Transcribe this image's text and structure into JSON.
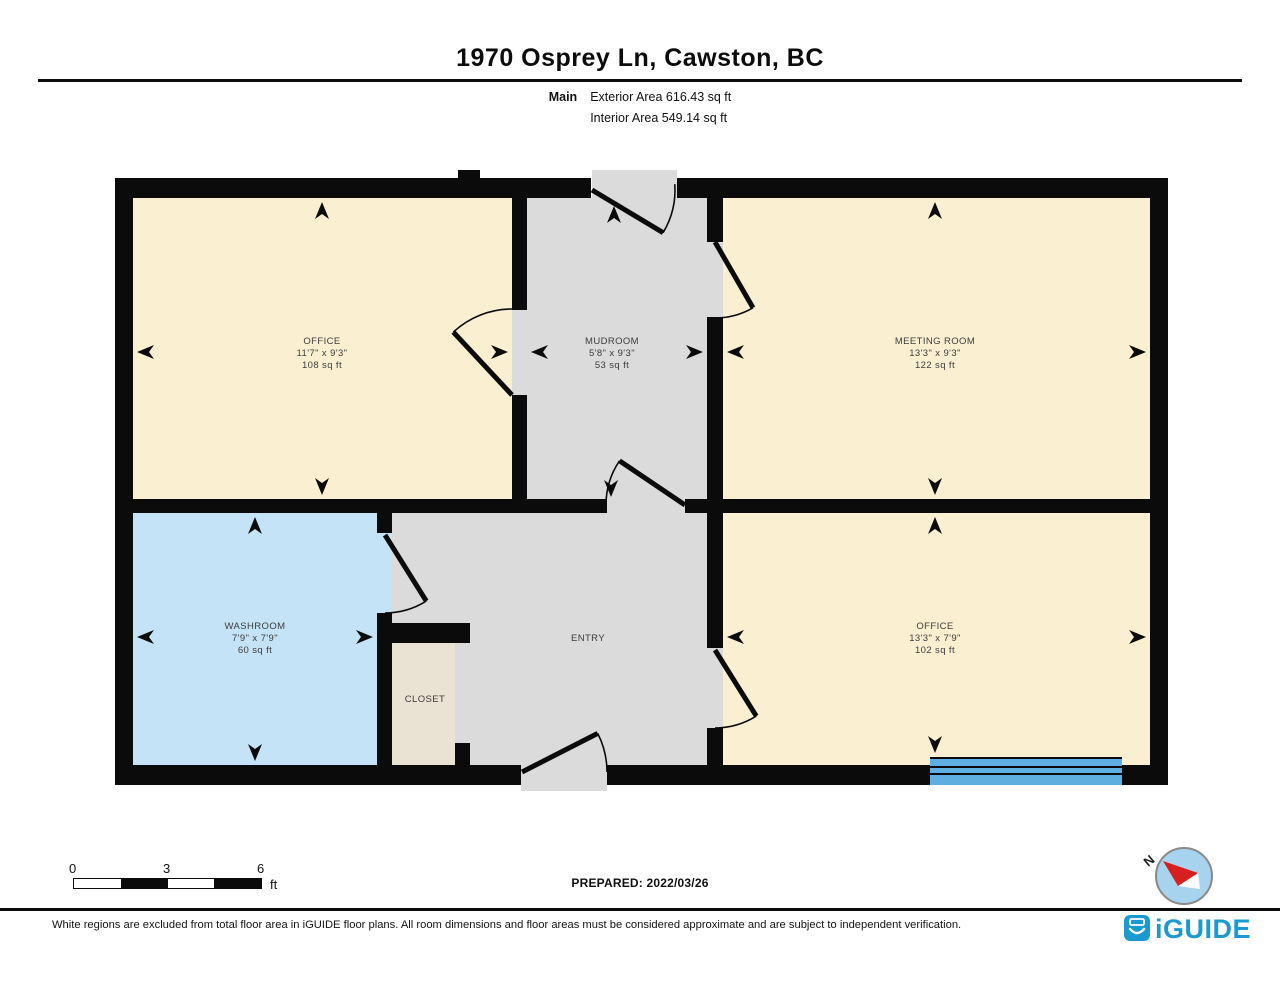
{
  "page": {
    "title": "1970 Osprey Ln, Cawston, BC",
    "floor_label": "Main",
    "exterior_area": "Exterior Area 616.43 sq ft",
    "interior_area": "Interior Area 549.14 sq ft",
    "prepared": "PREPARED: 2022/03/26",
    "disclaimer": "White regions are excluded from total floor area in iGUIDE floor plans. All room dimensions and floor areas must be considered approximate and are subject to independent verification.",
    "brand": "iGUIDE",
    "compass_label": "N"
  },
  "scale_bar": {
    "labels": [
      "0",
      "3",
      "6"
    ],
    "unit": "ft"
  },
  "colors": {
    "wall": "#0b0b0b",
    "room_cream": "#FAEFD1",
    "room_gray": "#DBDBDB",
    "room_blue": "#C5E3F7",
    "room_tan": "#EAE2D2",
    "window_blue": "#5FAEE0",
    "brand_blue": "#1B9AD2",
    "compass_fill": "#A8D3EE",
    "needle_red": "#D81F1F",
    "label_text": "#3c3c3c"
  },
  "floorplan": {
    "rooms": [
      {
        "name": "OFFICE",
        "dims": "11'7\" x 9'3\"",
        "area": "108 sq ft",
        "fill": "room_cream",
        "rect": [
          133,
          198,
          379,
          301
        ],
        "label": [
          322,
          352
        ],
        "arrows": [
          [
            "up",
            322,
            202
          ],
          [
            "down",
            322,
            495
          ],
          [
            "left",
            137,
            352
          ],
          [
            "right",
            508,
            352
          ]
        ]
      },
      {
        "name": "MUDROOM",
        "dims": "5'8\" x 9'3\"",
        "area": "53 sq ft",
        "fill": "room_gray",
        "rect": [
          527,
          198,
          180,
          301
        ],
        "label": [
          612,
          352
        ],
        "arrows": [
          [
            "up",
            614,
            206
          ],
          [
            "down",
            611,
            497
          ],
          [
            "left",
            531,
            352
          ],
          [
            "right",
            703,
            352
          ]
        ]
      },
      {
        "name": "MEETING ROOM",
        "dims": "13'3\" x 9'3\"",
        "area": "122 sq ft",
        "fill": "room_cream",
        "rect": [
          723,
          198,
          427,
          301
        ],
        "label": [
          935,
          352
        ],
        "arrows": [
          [
            "up",
            935,
            202
          ],
          [
            "down",
            935,
            495
          ],
          [
            "left",
            727,
            352
          ],
          [
            "right",
            1146,
            352
          ]
        ]
      },
      {
        "name": "WASHROOM",
        "dims": "7'9\" x 7'9\"",
        "area": "60 sq ft",
        "fill": "room_blue",
        "rect": [
          133,
          513,
          244,
          252
        ],
        "label": [
          255,
          637
        ],
        "arrows": [
          [
            "up",
            255,
            517
          ],
          [
            "down",
            255,
            761
          ],
          [
            "left",
            137,
            637
          ],
          [
            "right",
            373,
            637
          ]
        ]
      },
      {
        "name": "ENTRY",
        "dims": "",
        "area": "",
        "fill": "room_gray",
        "rect": [
          392,
          513,
          315,
          252
        ],
        "label": [
          588,
          638
        ],
        "arrows": []
      },
      {
        "name": "CLOSET",
        "dims": "",
        "area": "",
        "fill": "room_tan",
        "rect": [
          392,
          643,
          63,
          122
        ],
        "label": [
          425,
          699
        ],
        "arrows": []
      },
      {
        "name": "OFFICE",
        "dims": "13'3\" x 7'9\"",
        "area": "102 sq ft",
        "fill": "room_cream",
        "rect": [
          723,
          513,
          427,
          252
        ],
        "label": [
          935,
          637
        ],
        "arrows": [
          [
            "up",
            935,
            517
          ],
          [
            "down",
            935,
            753
          ],
          [
            "left",
            727,
            637
          ],
          [
            "right",
            1146,
            637
          ]
        ]
      }
    ],
    "extra_fills": [
      {
        "rect": [
          592,
          170,
          85,
          30
        ],
        "fill": "room_gray"
      },
      {
        "rect": [
          512,
          310,
          15,
          85
        ],
        "fill": "room_gray"
      },
      {
        "rect": [
          707,
          242,
          16,
          75
        ],
        "fill": "room_gray"
      },
      {
        "rect": [
          607,
          499,
          78,
          14
        ],
        "fill": "room_gray"
      },
      {
        "rect": [
          707,
          648,
          16,
          80
        ],
        "fill": "room_gray"
      },
      {
        "rect": [
          377,
          533,
          15,
          80
        ],
        "fill": "room_blue"
      },
      {
        "rect": [
          521,
          765,
          86,
          26
        ],
        "fill": "room_gray"
      }
    ],
    "walls": [
      [
        115,
        178,
        476,
        20
      ],
      [
        677,
        178,
        491,
        20
      ],
      [
        115,
        765,
        406,
        20
      ],
      [
        607,
        765,
        561,
        20
      ],
      [
        115,
        178,
        18,
        607
      ],
      [
        1150,
        178,
        18,
        607
      ],
      [
        133,
        499,
        474,
        14
      ],
      [
        685,
        499,
        465,
        14
      ],
      [
        512,
        198,
        15,
        112
      ],
      [
        512,
        395,
        15,
        104
      ],
      [
        707,
        198,
        16,
        44
      ],
      [
        707,
        317,
        16,
        182
      ],
      [
        707,
        513,
        16,
        135
      ],
      [
        707,
        728,
        16,
        37
      ],
      [
        377,
        513,
        15,
        20
      ],
      [
        377,
        613,
        15,
        152
      ],
      [
        377,
        623,
        93,
        20
      ],
      [
        455,
        743,
        15,
        22
      ],
      [
        458,
        170,
        22,
        12
      ]
    ],
    "doors": [
      {
        "hinge": [
          592,
          190
        ],
        "r": 83,
        "a0": -4,
        "a1": 31,
        "leaf": 31
      },
      {
        "hinge": [
          512,
          395
        ],
        "r": 86,
        "a0": -133,
        "a1": -90,
        "leaf": -133
      },
      {
        "hinge": [
          715,
          242
        ],
        "r": 76,
        "a0": 60,
        "a1": 90,
        "leaf": 60
      },
      {
        "hinge": [
          685,
          505
        ],
        "r": 79,
        "a0": 180,
        "a1": 214,
        "leaf": 214
      },
      {
        "hinge": [
          385,
          535
        ],
        "r": 78,
        "a0": 58,
        "a1": 90,
        "leaf": 58
      },
      {
        "hinge": [
          522,
          772
        ],
        "r": 85,
        "a0": -27,
        "a1": 0,
        "leaf": -27
      },
      {
        "hinge": [
          715,
          650
        ],
        "r": 78,
        "a0": 58,
        "a1": 90,
        "leaf": 58
      }
    ],
    "window": {
      "x": 930,
      "y": 757,
      "w": 192,
      "h": 28,
      "lines": [
        757,
        766,
        773
      ]
    },
    "compass": {
      "cx": 1184,
      "cy": 876,
      "r": 28,
      "red": [
        [
          1163,
          861
        ],
        [
          1198,
          873
        ],
        [
          1178,
          886
        ]
      ],
      "white": [
        [
          1198,
          873
        ],
        [
          1178,
          886
        ],
        [
          1200,
          889
        ]
      ],
      "n_pos": [
        1152,
        864
      ],
      "n_rot": -40
    },
    "logo": {
      "x": 1124,
      "y": 915,
      "size": 26,
      "text_x": 1155,
      "text_y": 938
    }
  }
}
